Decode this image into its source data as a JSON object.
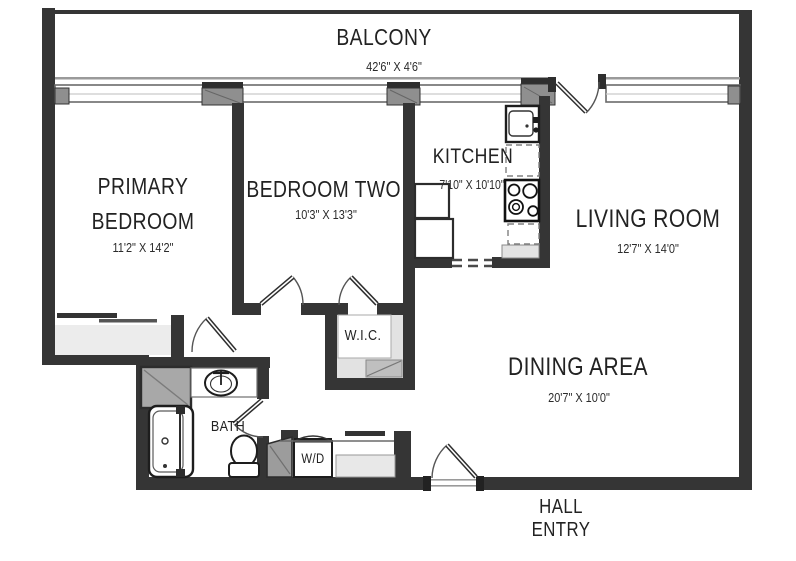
{
  "rooms": {
    "balcony": {
      "label": "BALCONY",
      "dims": "42'6\" X 4'6\""
    },
    "primary_bedroom": {
      "label_line1": "PRIMARY",
      "label_line2": "BEDROOM",
      "dims": "11'2\" X 14'2\""
    },
    "bedroom_two": {
      "label": "BEDROOM TWO",
      "dims": "10'3\" X 13'3\""
    },
    "kitchen": {
      "label": "KITCHEN",
      "dims": "7'10\" X 10'10\""
    },
    "living_room": {
      "label": "LIVING ROOM",
      "dims": "12'7\" X 14'0\""
    },
    "dining_area": {
      "label": "DINING AREA",
      "dims": "20'7\" X 10'0\""
    },
    "wic": {
      "label": "W.I.C."
    },
    "bath": {
      "label": "BATH"
    },
    "laundry": {
      "label": "W/D"
    },
    "hall_entry": {
      "label_line1": "HALL",
      "label_line2": "ENTRY"
    }
  },
  "colors": {
    "wall": "#353535",
    "mullion": "#8f8f8f",
    "closet_fill": "#ececec",
    "counter_fill": "#e3e3e3",
    "storage_fill": "#9c9c9c"
  }
}
